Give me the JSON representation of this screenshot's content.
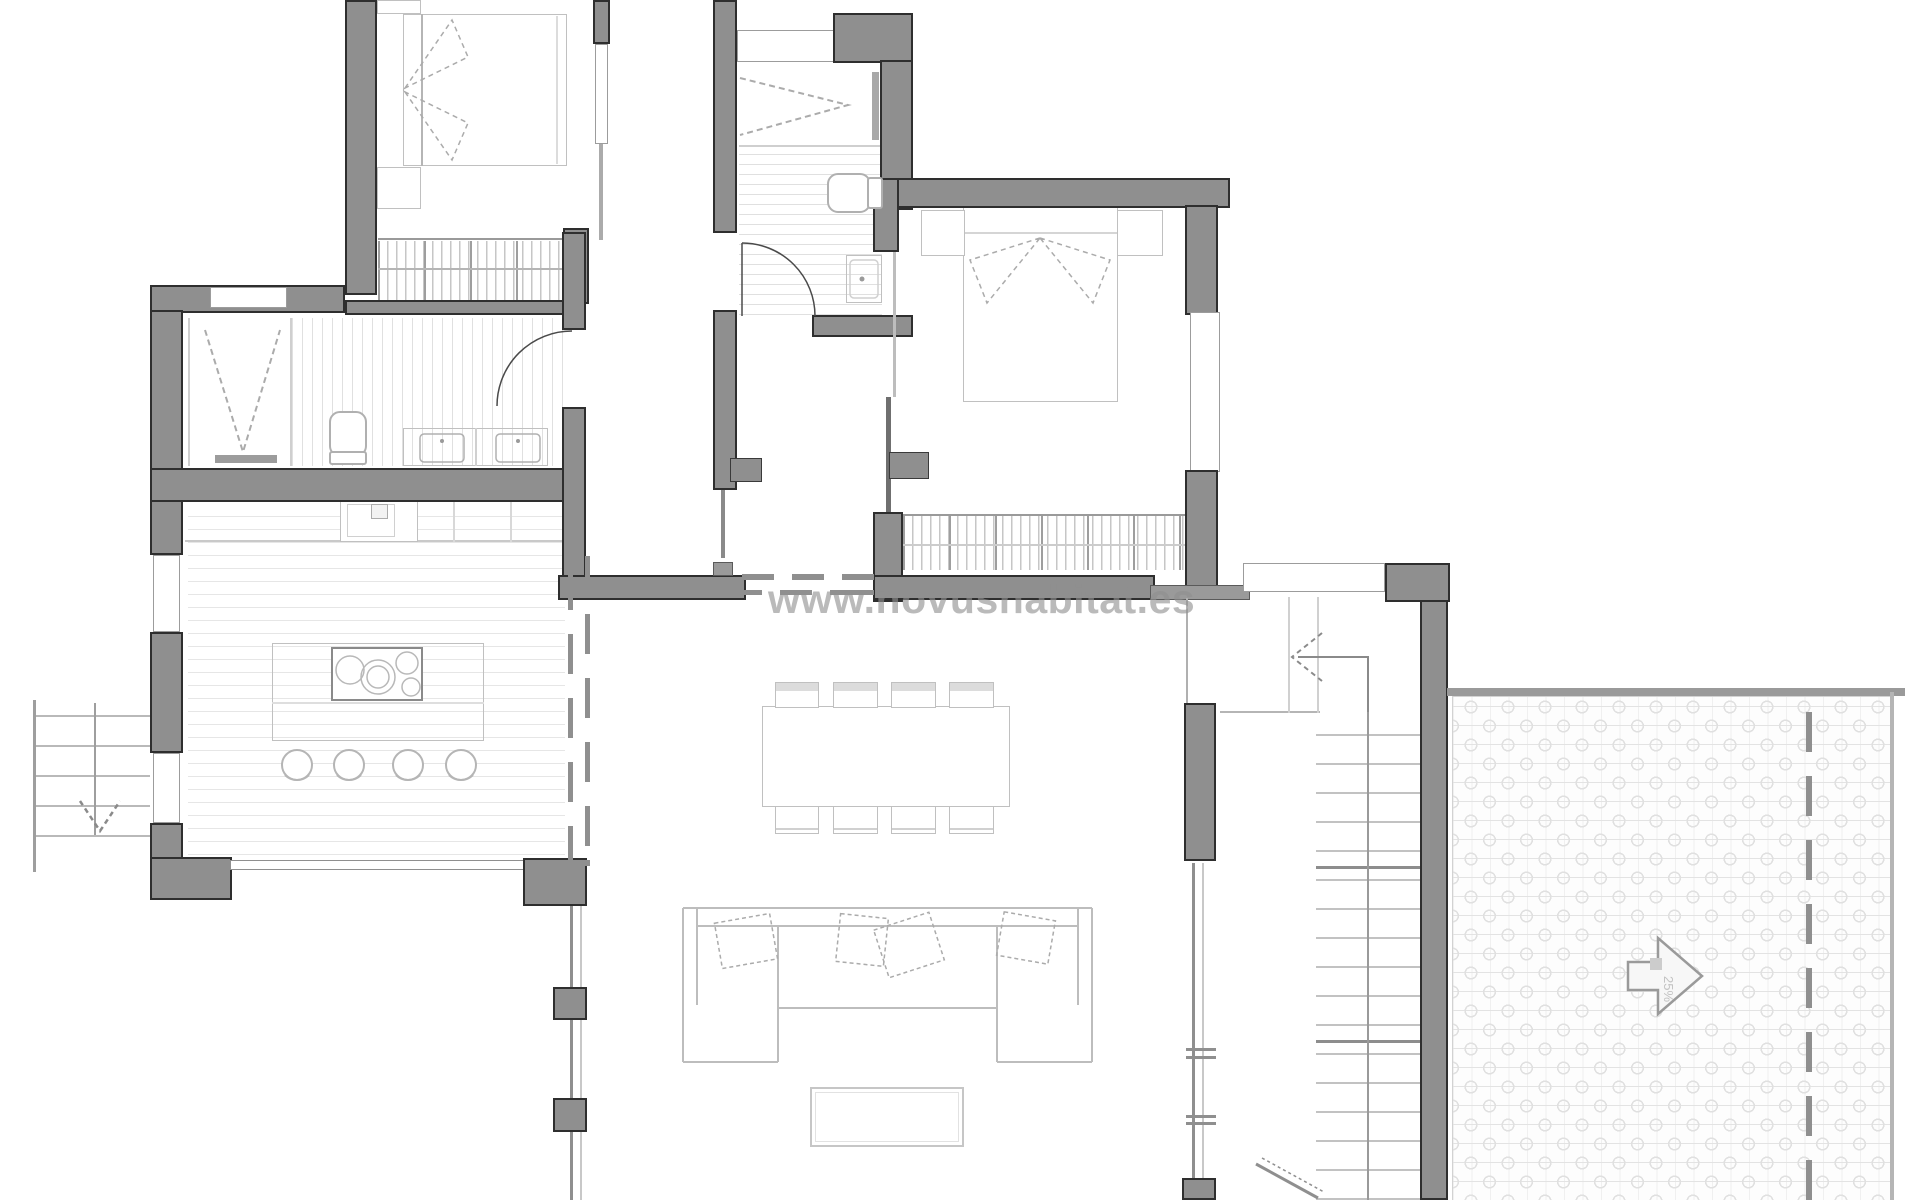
{
  "watermark": {
    "text": "www.novushabitat.es"
  },
  "annotations": {
    "terrace_slope_arrow": {
      "icon": "arrow-right-icon",
      "label": "25%"
    },
    "stair_direction_arrow": {
      "icon": "arrow-left-icon"
    },
    "exterior_stair_arrow": {
      "icon": "arrow-down-icon"
    }
  },
  "palette": {
    "paper": "#ffffff",
    "wall_fill": "#8f8f8f",
    "wall_outline": "#2e2e2e",
    "glass_frame": "#9c9c9c",
    "furniture_line": "#c0c0c0",
    "floor_hatch": "#e6e6e6",
    "tile_hatch": "#e0e0e0",
    "wardrobe_hatch": "#c6c6c6",
    "dash_line": "#8f8f8f",
    "watermark_color": "#8f8f8f"
  }
}
